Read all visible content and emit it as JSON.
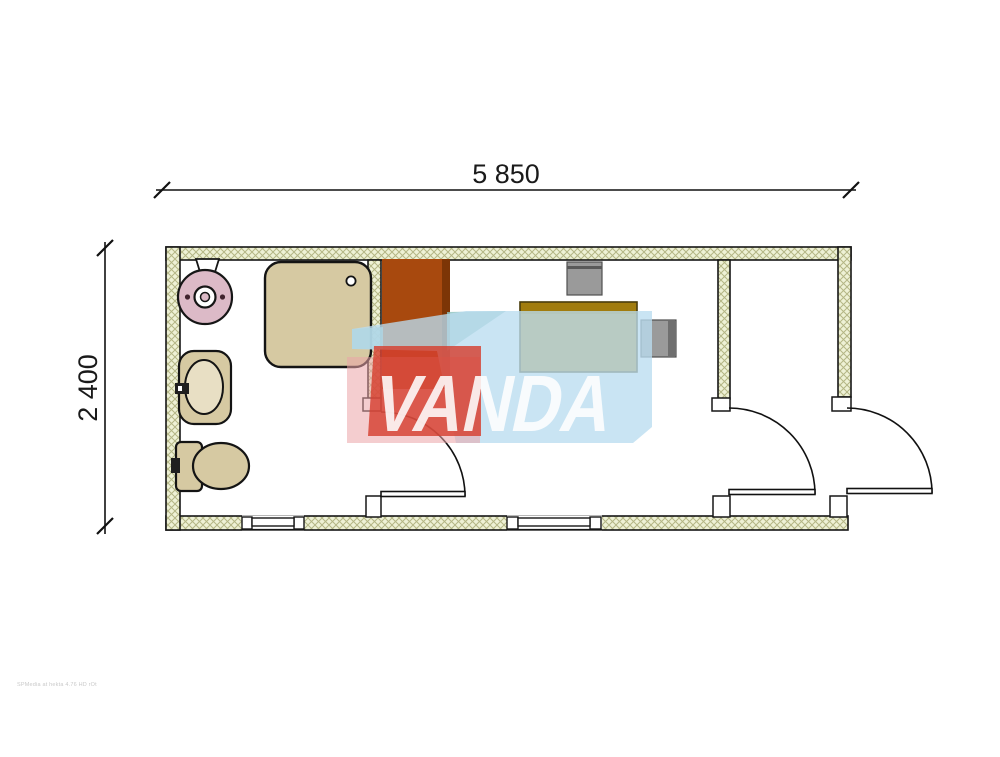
{
  "dimensions": {
    "width_label": "5 850",
    "height_label": "2 400"
  },
  "watermark": {
    "text": "VANDA",
    "text_color": "#ffffff",
    "red": "#d5402f",
    "pink": "#eba4a8",
    "blue": "#badcf0",
    "teal": "#8cc2bd"
  },
  "fine_print": {
    "text": "SPMedia at hekta 4.76 HD rOt"
  },
  "plan": {
    "wall_fill": "#eef1d5",
    "wall_hatch_color": "#b4b685",
    "line_color": "#161616",
    "fixture_fill": "#d6c9a2",
    "water_heater_fill": "#dcbac7",
    "wardrobe_fill": "#a8490e",
    "desk_fill": "#b28f24",
    "chair_fill": "#9a9a9a",
    "door_count": 3,
    "window_count": 2,
    "symbols": [
      "water-heater",
      "shower-tray",
      "washbasin",
      "toilet",
      "wardrobe",
      "desk",
      "office-chair",
      "office-chair"
    ]
  }
}
